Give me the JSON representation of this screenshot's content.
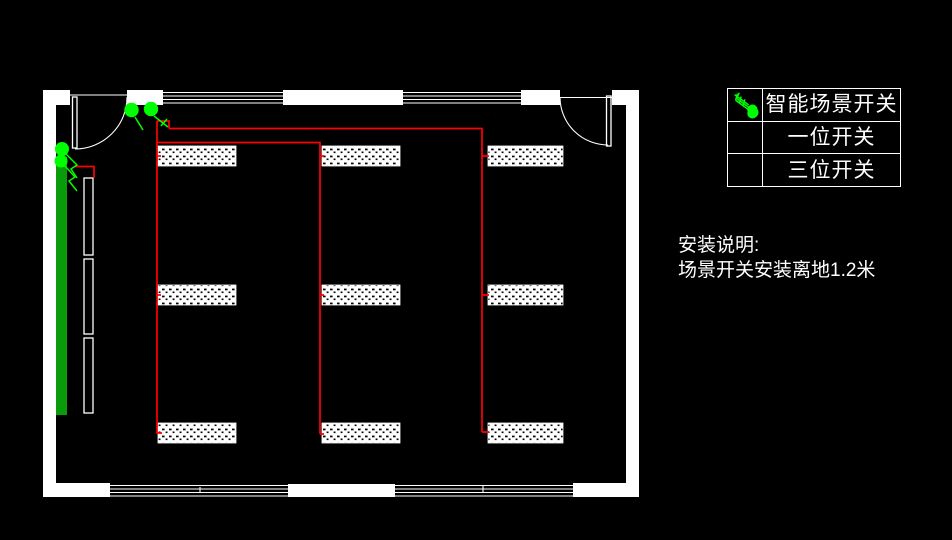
{
  "window": {
    "width": 952,
    "height": 540,
    "background": "#000000"
  },
  "colors": {
    "wall": "#ffffff",
    "wire": "#ff0000",
    "device": "#00ff00",
    "curtain": "#0a9b0a"
  },
  "legend": {
    "rows": [
      {
        "icon": "scene-switch-icon",
        "label": "智能场景开关"
      },
      {
        "icon": "one-gang-switch-icon",
        "label": "一位开关"
      },
      {
        "icon": "three-gang-switch-icon",
        "label": "三位开关"
      }
    ]
  },
  "notes": {
    "title": "安装说明:",
    "body": "场景开关安装离地1.2米"
  },
  "plan": {
    "light_fixture_count": 9,
    "fixture_rows": 3,
    "fixture_cols": 3,
    "scene_switch_count": 2,
    "wall_switch_count": 2
  }
}
